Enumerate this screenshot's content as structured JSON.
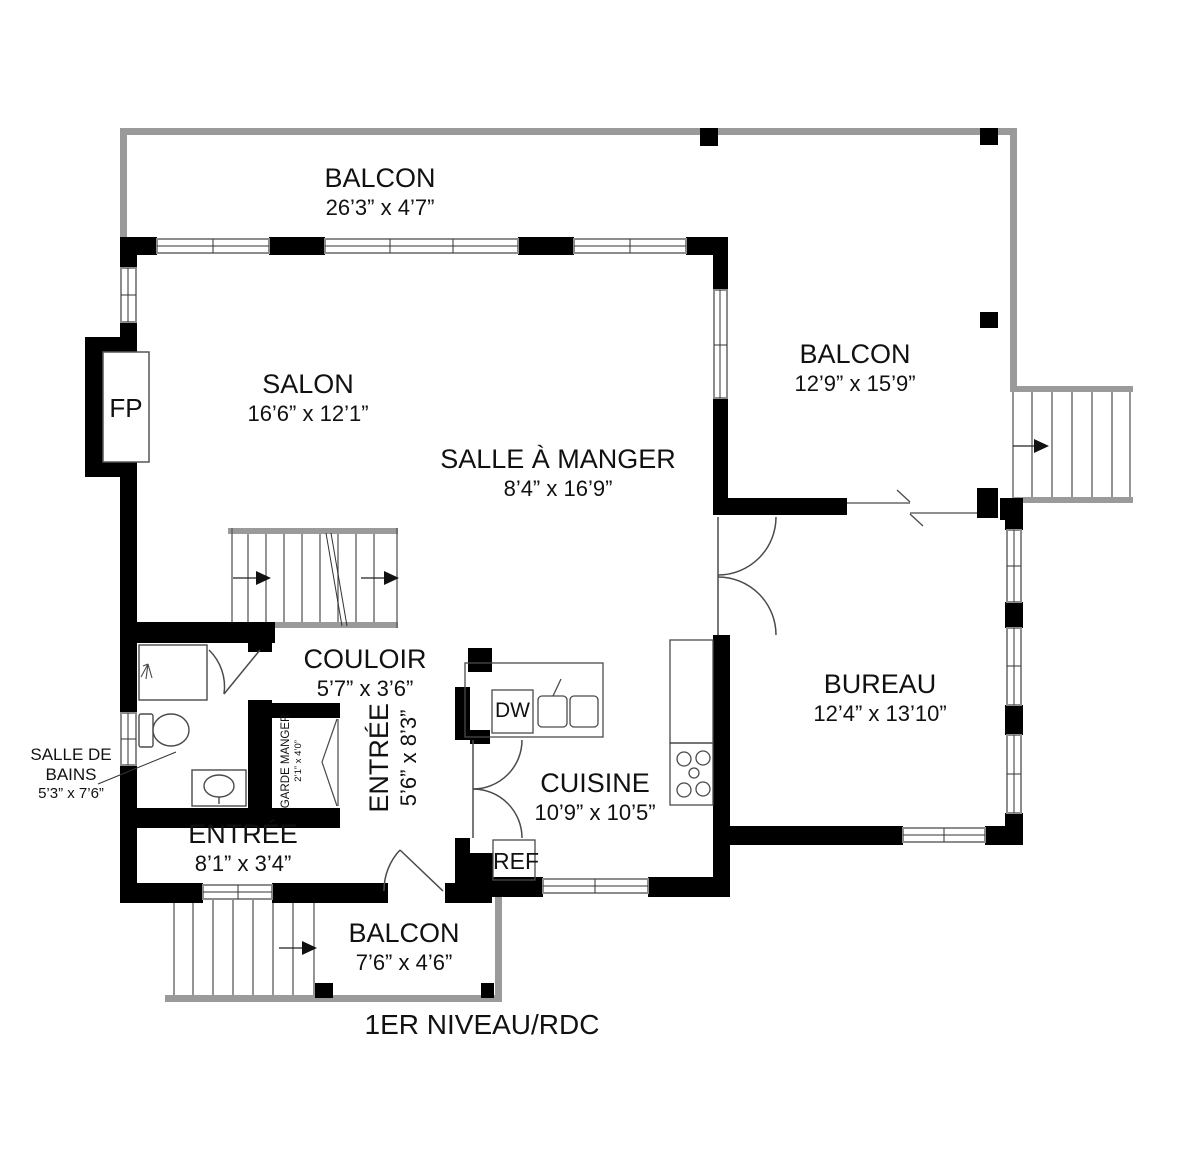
{
  "plan": {
    "level_label": "1ER NIVEAU/RDC"
  },
  "rooms": {
    "balcon_top": {
      "name": "BALCON",
      "dims": "26’3” x 4’7”"
    },
    "salon": {
      "name": "SALON",
      "dims": "16’6” x 12’1”"
    },
    "salle_a_manger": {
      "name": "SALLE À MANGER",
      "dims": "8’4” x 16’9”"
    },
    "balcon_right": {
      "name": "BALCON",
      "dims": "12’9” x 15’9”"
    },
    "bureau": {
      "name": "BUREAU",
      "dims": "12’4” x 13’10”"
    },
    "couloir": {
      "name": "COULOIR",
      "dims": "5’7” x 3’6”"
    },
    "cuisine": {
      "name": "CUISINE",
      "dims": "10’9” x 10’5”"
    },
    "entree_hall": {
      "name": "ENTRÉE",
      "dims": "5’6” x 8’3”"
    },
    "entree_room": {
      "name": "ENTRÉE",
      "dims": "8’1” x 3’4”"
    },
    "salle_de_bains": {
      "name": "SALLE DE BAINS",
      "dims": "5’3” x 7’6”"
    },
    "garde_manger": {
      "name": "GARDE MANGER",
      "dims": "2’1” x 4’0”"
    },
    "balcon_bottom": {
      "name": "BALCON",
      "dims": "7’6” x 4’6”"
    }
  },
  "fixtures": {
    "fireplace": "FP",
    "dishwasher": "DW",
    "refrigerator": "REF"
  },
  "colors": {
    "wall": "#000000",
    "balcony_line": "#9a9a9a",
    "thin_line": "#4a4a4a",
    "text": "#111111",
    "background": "#ffffff"
  }
}
